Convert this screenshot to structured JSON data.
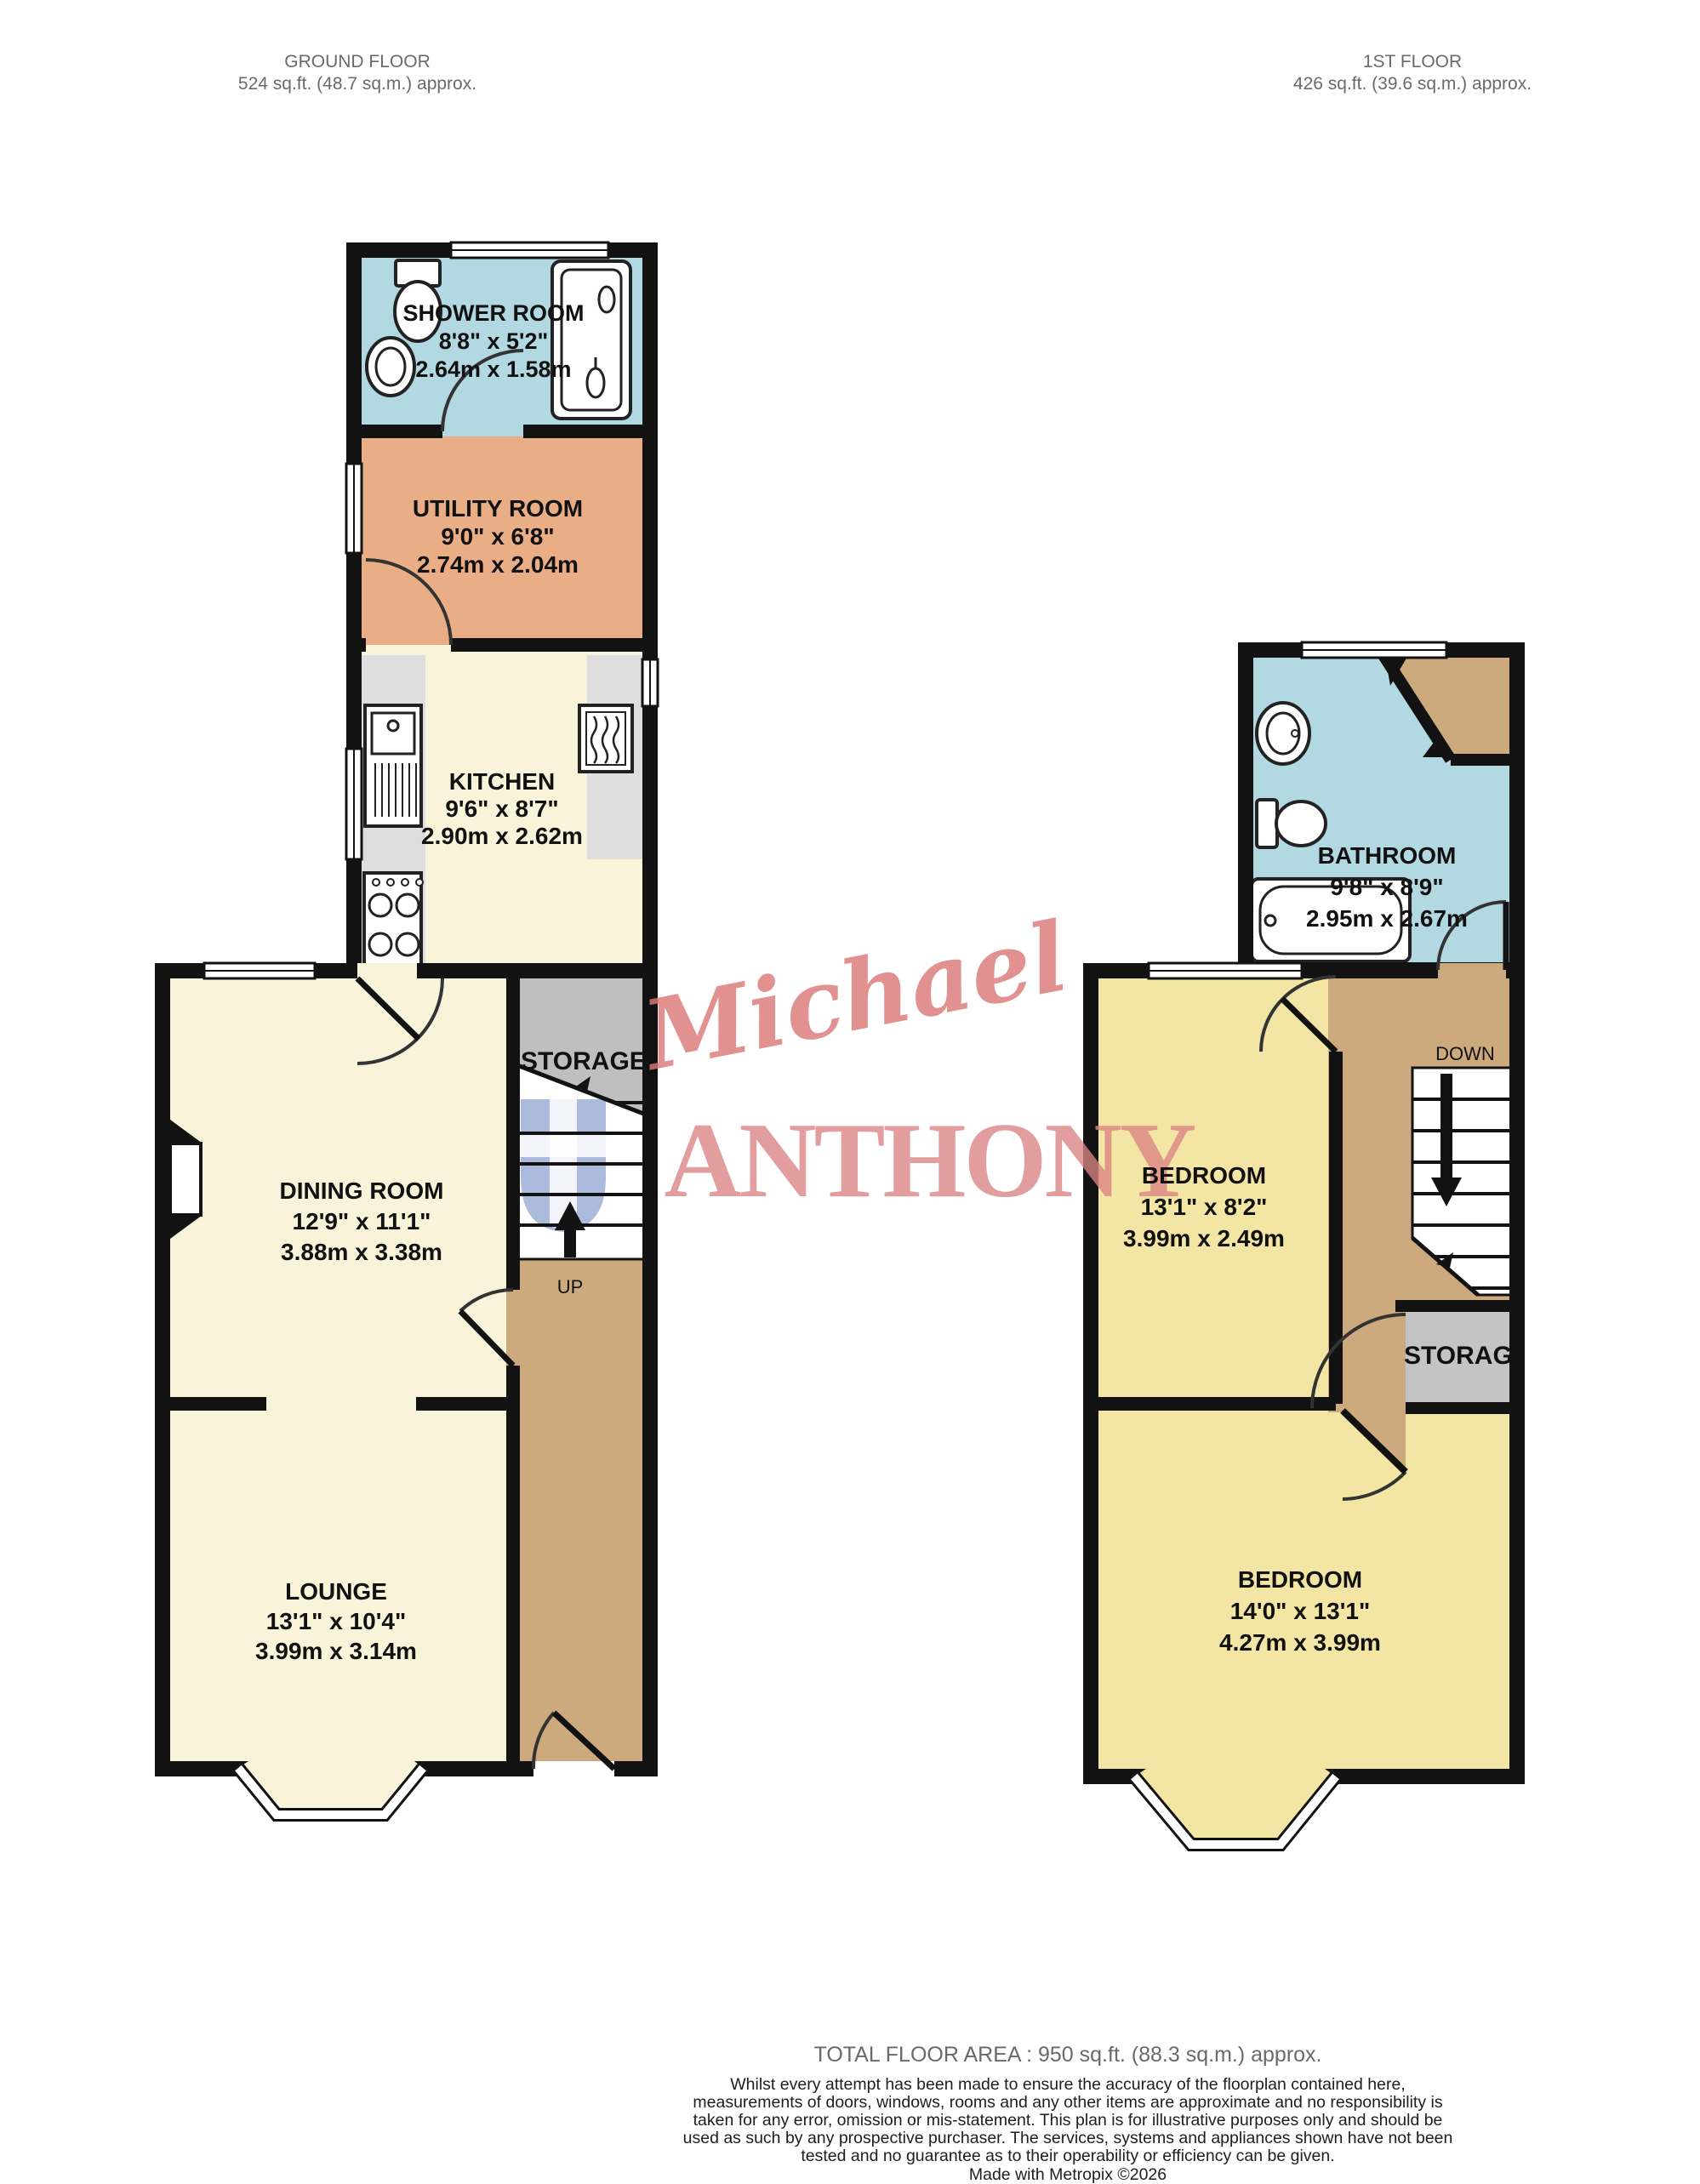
{
  "header": {
    "ground_floor": {
      "title": "GROUND FLOOR",
      "area": "524 sq.ft. (48.7 sq.m.) approx."
    },
    "first_floor": {
      "title": "1ST FLOOR",
      "area": "426 sq.ft. (39.6 sq.m.) approx."
    }
  },
  "ground_floor": {
    "rooms": {
      "shower_room": {
        "name": "SHOWER ROOM",
        "imperial": "8'8\" x 5'2\"",
        "metric": "2.64m x 1.58m"
      },
      "utility_room": {
        "name": "UTILITY ROOM",
        "imperial": "9'0\" x 6'8\"",
        "metric": "2.74m x 2.04m"
      },
      "kitchen": {
        "name": "KITCHEN",
        "imperial": "9'6\" x 8'7\"",
        "metric": "2.90m x 2.62m"
      },
      "dining_room": {
        "name": "DINING ROOM",
        "imperial": "12'9\" x 11'1\"",
        "metric": "3.88m x 3.38m"
      },
      "lounge": {
        "name": "LOUNGE",
        "imperial": "13'1\" x 10'4\"",
        "metric": "3.99m x 3.14m"
      }
    },
    "storage_label": "STORAGE",
    "stairs_label": "UP"
  },
  "first_floor": {
    "rooms": {
      "bathroom": {
        "name": "BATHROOM",
        "imperial": "9'8\" x 8'9\"",
        "metric": "2.95m x 2.67m"
      },
      "bedroom_one": {
        "name": "BEDROOM",
        "imperial": "13'1\" x 8'2\"",
        "metric": "3.99m x 2.49m"
      },
      "bedroom_two": {
        "name": "BEDROOM",
        "imperial": "14'0\" x 13'1\"",
        "metric": "4.27m x 3.99m"
      }
    },
    "storage_label": "STORAGE",
    "stairs_label": "DOWN"
  },
  "watermark": {
    "script": "Michael",
    "serif": "ANTHONY"
  },
  "footer": {
    "total_area": "TOTAL FLOOR AREA : 950 sq.ft. (88.3 sq.m.) approx.",
    "disclaimer": "Whilst every attempt has been made to ensure the accuracy of the floorplan contained here, measurements of doors, windows, rooms and any other items are approximate and no responsibility is taken for any error, omission or mis-statement. This plan is for illustrative purposes only and should be used as such by any prospective purchaser. The services, systems and appliances shown have not been tested and no guarantee as to their operability or efficiency can be given.",
    "credit": "Made with Metropix ©2026"
  },
  "colors": {
    "wall": "#121212",
    "bathroom_blue": "#b2d8e2",
    "utility_orange": "#e9ae85",
    "living_cream": "#f9f3da",
    "bedroom_yellow": "#f3e5a3",
    "hall_brown": "#cdaa7e",
    "storage_grey": "#bfbfbf",
    "counter_grey": "#dedede",
    "watermark_red": "#db8383",
    "shield_blue": "#5b79b8",
    "header_grey": "#6a6a6a"
  }
}
